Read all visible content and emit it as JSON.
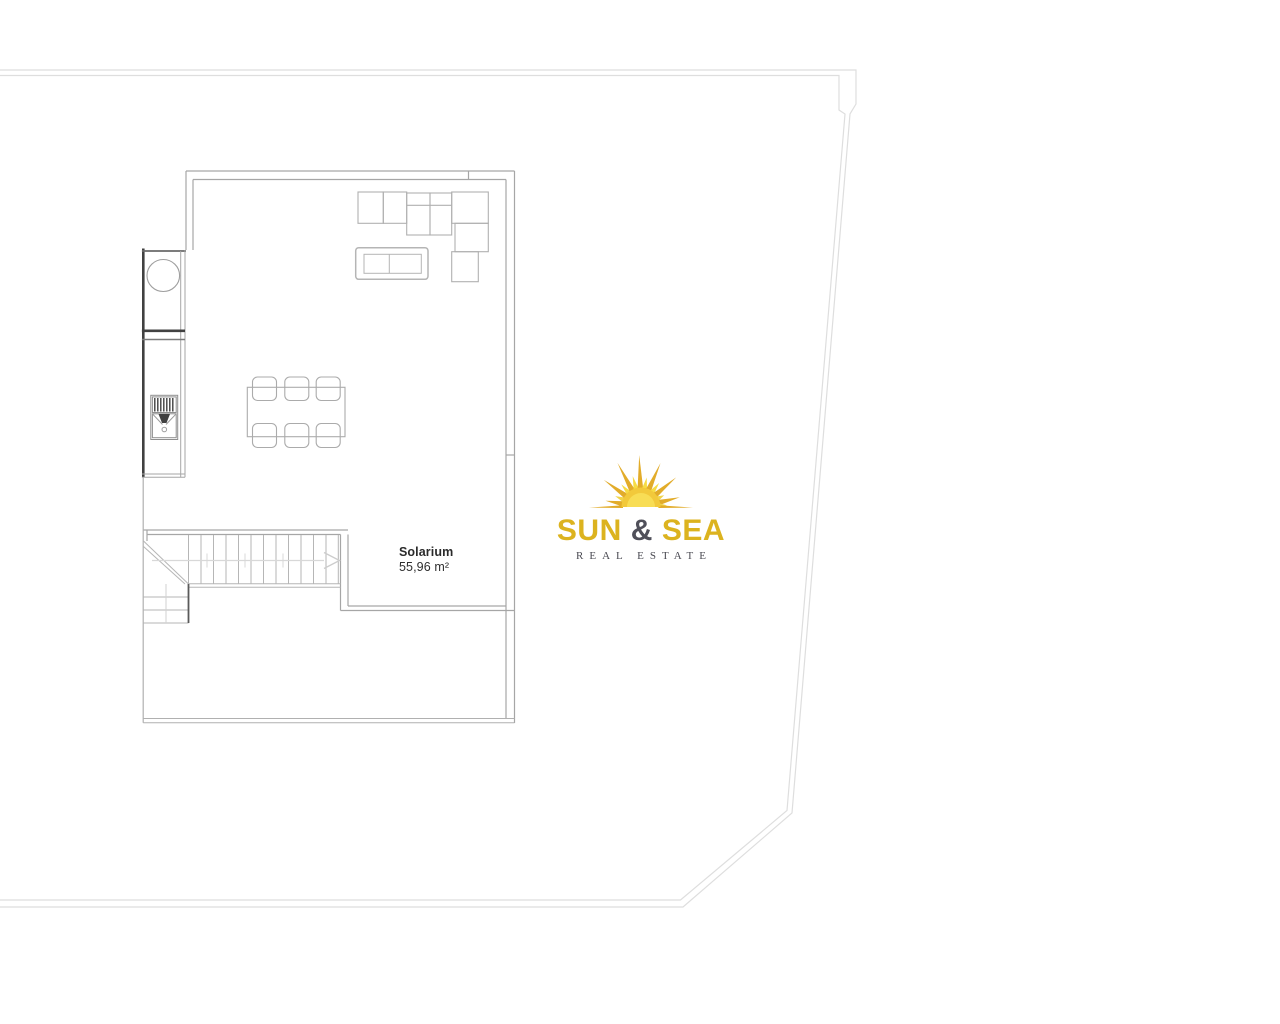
{
  "floor_plan": {
    "room_label": "Solarium",
    "room_area": "55,96 m²",
    "label_color": "#2b2b2b",
    "features": [
      "dining-table-six-chairs",
      "l-shaped-sofa",
      "coffee-table",
      "outdoor-kitchen-with-sink",
      "staircase-with-winders",
      "plot-boundary"
    ]
  },
  "logo": {
    "word_sun": "SUN",
    "ampersand": "&",
    "word_sea": "SEA",
    "subtitle": "REAL ESTATE",
    "colors": {
      "gold": "#DCB31F",
      "charcoal": "#50505A",
      "subtitle_gray": "#4A4A52",
      "ray_gold": "#E2AC2A",
      "ray_yellow": "#F6DC45",
      "sun_disc": "#F2C93B"
    }
  }
}
